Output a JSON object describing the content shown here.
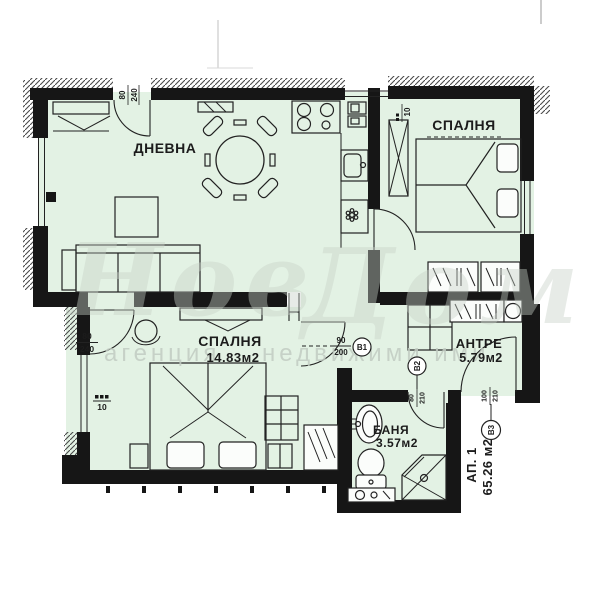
{
  "rooms": {
    "living": {
      "name": "ДНЕВНА"
    },
    "bedroom1": {
      "name": "СПАЛНЯ"
    },
    "bedroom2": {
      "name": "СПАЛНЯ",
      "area": "14.83м2"
    },
    "hallway": {
      "name": "АНТРЕ",
      "area": "5.79м2"
    },
    "bathroom": {
      "name": "БАНЯ",
      "area": "3.57м2"
    }
  },
  "apartment": {
    "label": "АП. 1",
    "area": "65.26 м2"
  },
  "doors": {
    "v1": {
      "tag": "В1",
      "width": "90",
      "height": "200"
    },
    "v2": {
      "tag": "В2",
      "width": "80",
      "height": "210"
    },
    "v3": {
      "tag": "В3",
      "width": "100",
      "height": "210"
    },
    "terrace_door": {
      "width": "80",
      "height": "240"
    },
    "bedroom2_door": {
      "width": "80",
      "height": "240"
    }
  },
  "window_labels": {
    "bedroom2": "10",
    "kitchen": "10"
  },
  "watermark": {
    "word1": "Нов",
    "word2": "Дом",
    "sub1": "агенция",
    "sub2": "недвижими ими"
  },
  "colors": {
    "room_fill": "#e3f2e4",
    "wall": "#161616",
    "line": "#222222",
    "hatch": "#4a4a4a",
    "watermark": "#c7d1c7",
    "background": "#ffffff"
  }
}
